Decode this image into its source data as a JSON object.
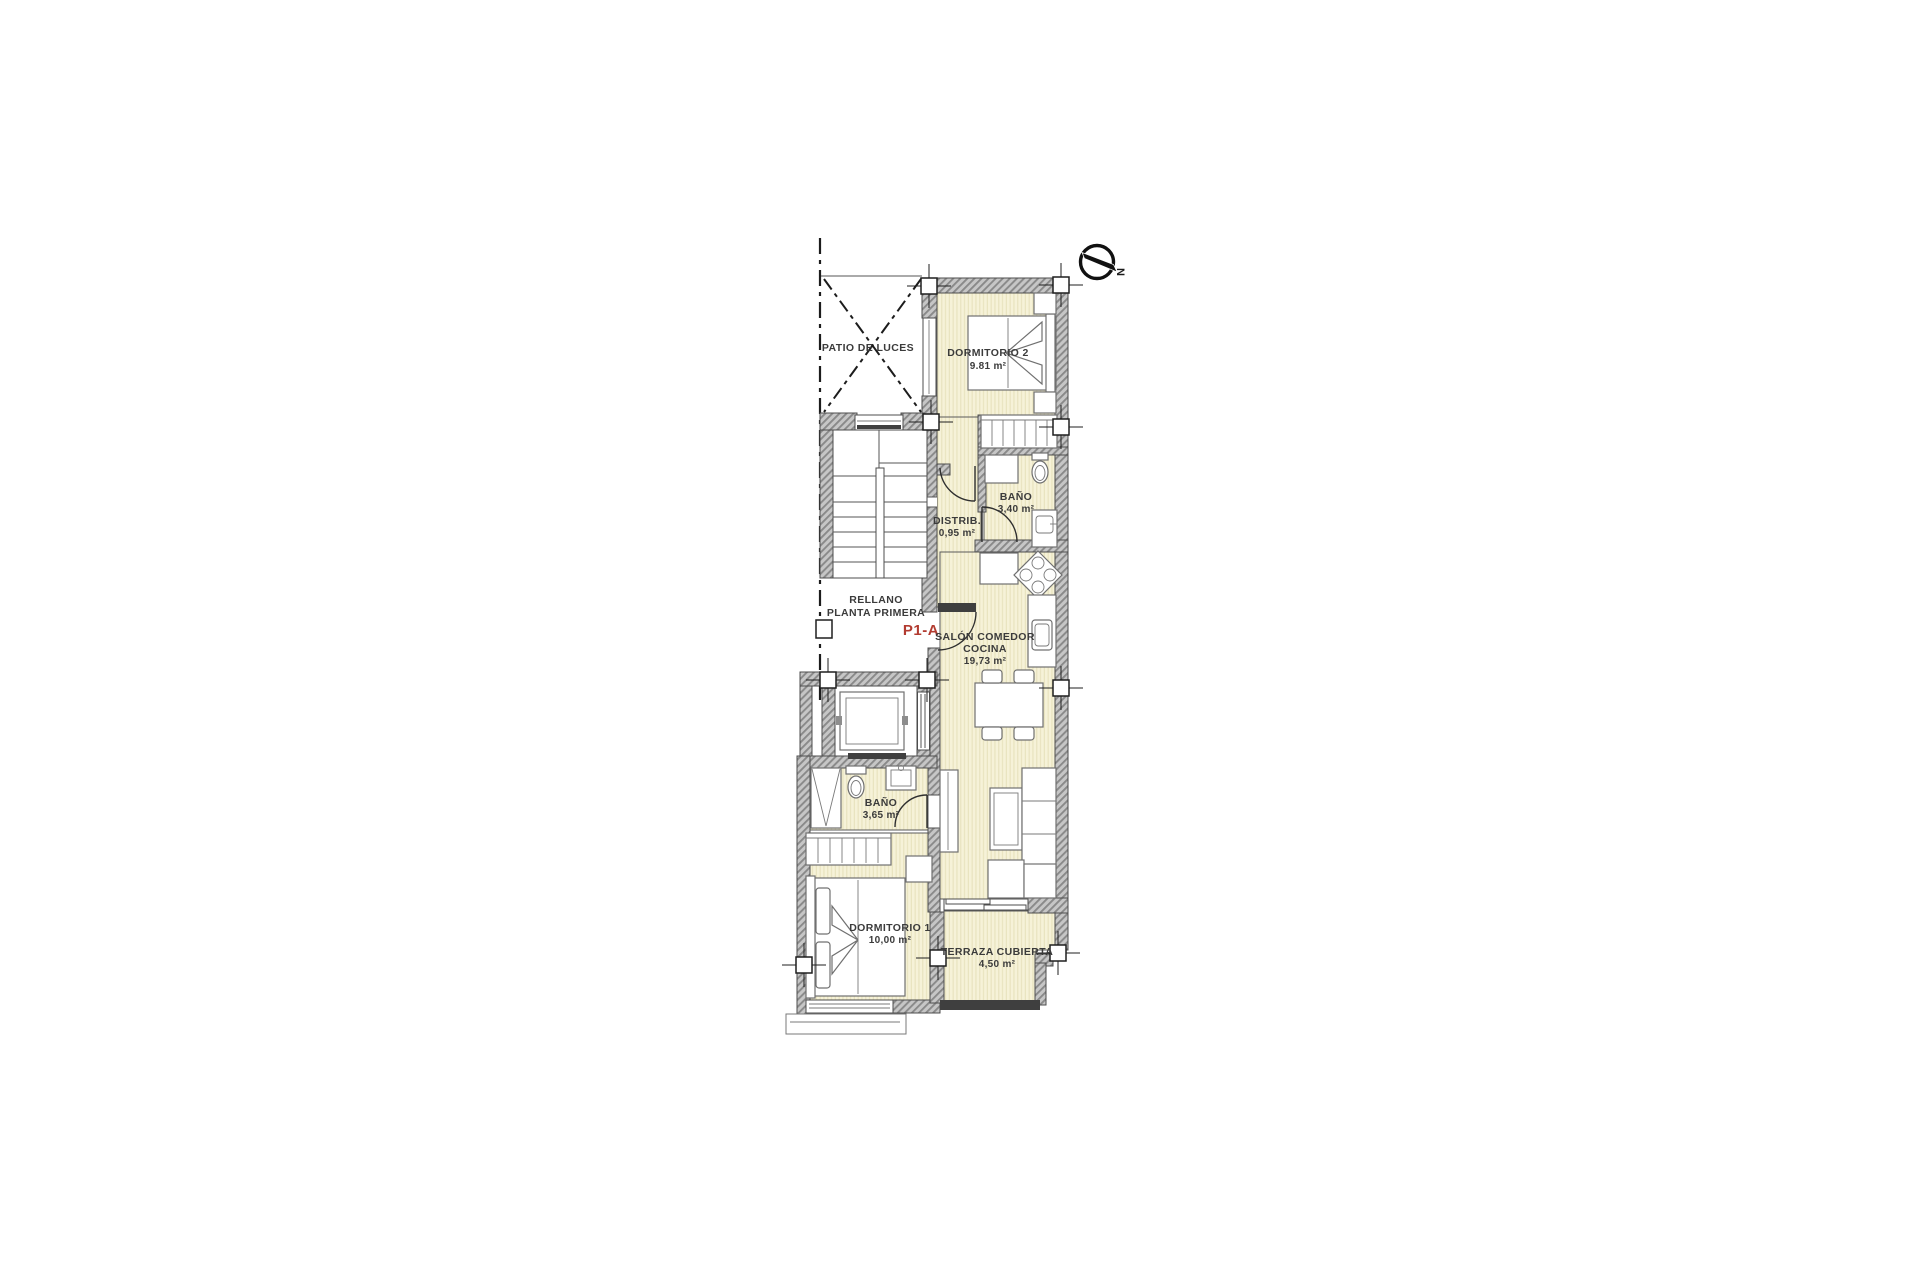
{
  "plan": {
    "unit": {
      "label": "P1-A",
      "color": "#b23b30"
    },
    "compass": {
      "letter": "N"
    },
    "rooms": {
      "patio": {
        "name": "PATIO DE LUCES"
      },
      "dormitorio2": {
        "name": "DORMITORIO 2",
        "area": "9.81 m²"
      },
      "bano_340": {
        "name": "BAÑO",
        "area": "3,40 m²"
      },
      "distrib": {
        "name": "DISTRIB.",
        "area": "0,95 m²"
      },
      "rellano": {
        "line1": "RELLANO",
        "line2": "PLANTA PRIMERA"
      },
      "salon": {
        "line1": "SALÓN COMEDOR",
        "line2": "COCINA",
        "area": "19,73 m²"
      },
      "bano_365": {
        "name": "BAÑO",
        "area": "3,65 m²"
      },
      "dormitorio1": {
        "name": "DORMITORIO 1",
        "area": "10,00 m²"
      },
      "terraza": {
        "name": "TERRAZA CUBIERTA",
        "area": "4,50 m²"
      }
    },
    "colors": {
      "floor_fill": "#f6f2d8",
      "floor_stripe": "#e7e2bd",
      "wall_fill": "#c6c6c6",
      "wall_hatch": "#898989",
      "line": "#4d4d4d",
      "label_text": "#3b3b3b",
      "accent_red": "#b23b30"
    }
  }
}
